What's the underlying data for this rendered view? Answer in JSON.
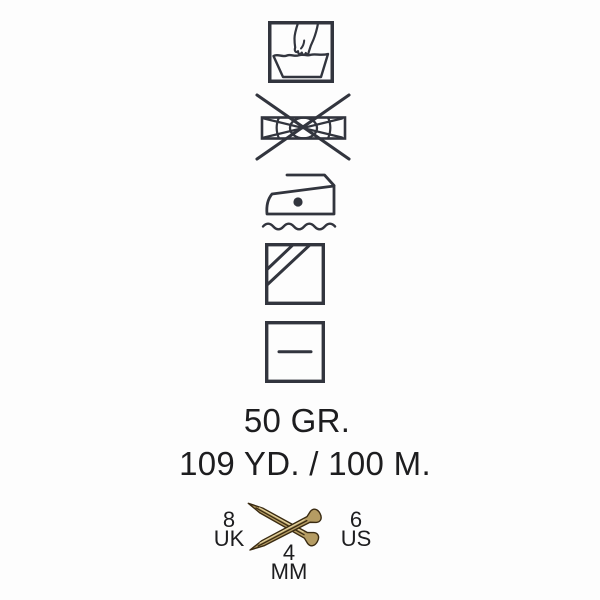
{
  "background": "#fdfdfd",
  "colors": {
    "ink": "#32353e",
    "text": "#1d1d1f",
    "needle_fill": "#b59c63",
    "needle_stroke": "#3a2b12",
    "needle_highlight": "#e3d3a0"
  },
  "care_symbols": [
    "hand-wash-icon",
    "do-not-wring-icon",
    "iron-one-dot-steam-icon",
    "dry-in-shade-icon",
    "dry-flat-icon"
  ],
  "label": {
    "weight": "50 GR.",
    "yardage": "109 YD. / 100 M."
  },
  "needles": {
    "uk_size": "8",
    "uk_label": "UK",
    "us_size": "6",
    "us_label": "US",
    "mm_size": "4",
    "mm_label": "MM"
  }
}
